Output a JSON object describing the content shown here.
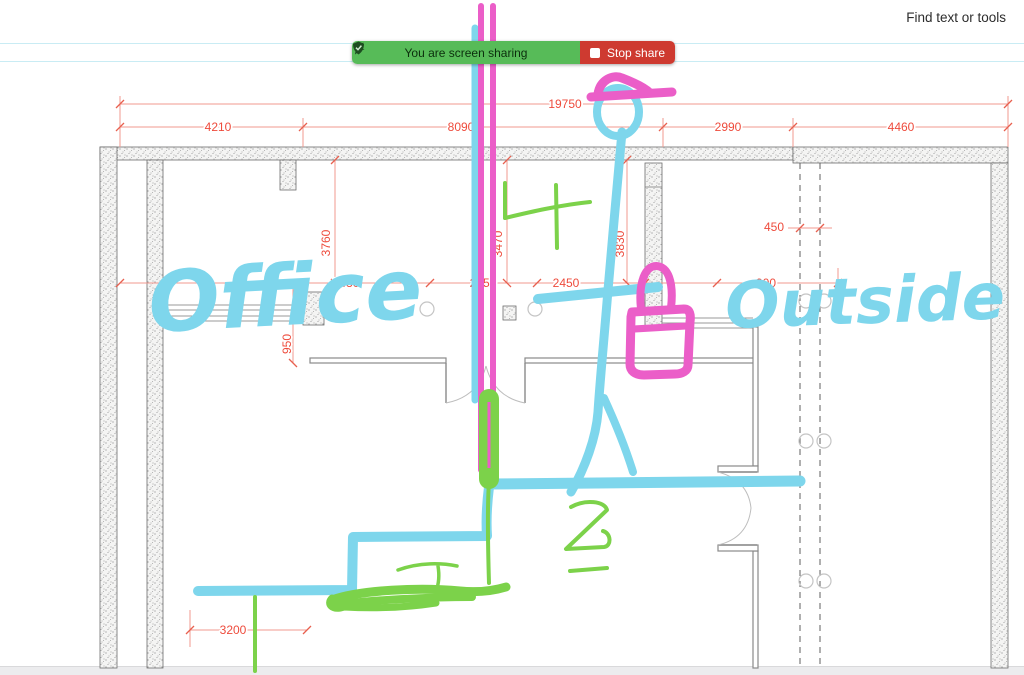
{
  "browser": {
    "find_tools_label": "Find text or tools"
  },
  "share_banner": {
    "message": "You are screen sharing",
    "stop_label": "Stop share",
    "colors": {
      "green": "#57bb58",
      "red": "#ce3a30"
    },
    "icons": [
      "cursor-icon",
      "shield-check-icon",
      "stop-square-icon"
    ]
  },
  "plan": {
    "handwriting": {
      "room_left": "Office",
      "room_right": "Outside"
    },
    "doodles": [
      "stick-figure",
      "pink-hat",
      "padlock",
      "pink-double-pipe",
      "green-scribbles",
      "cyan-route-lines"
    ],
    "colors": {
      "marker_cyan": "#7ed6ec",
      "marker_pink": "#eb5ec8",
      "marker_green": "#7cd24a",
      "dimension_red": "#ee4b3c"
    },
    "dimensions": [
      {
        "label": "19750",
        "x": 565,
        "y": 108,
        "rot": 0
      },
      {
        "label": "4210",
        "x": 218,
        "y": 131,
        "rot": 0
      },
      {
        "label": "8090",
        "x": 461,
        "y": 131,
        "rot": 0
      },
      {
        "label": "2990",
        "x": 728,
        "y": 131,
        "rot": 0
      },
      {
        "label": "4460",
        "x": 901,
        "y": 131,
        "rot": 0
      },
      {
        "label": "3760",
        "x": 330,
        "y": 243,
        "rot": -90
      },
      {
        "label": "3470",
        "x": 502,
        "y": 244,
        "rot": -90
      },
      {
        "label": "3830",
        "x": 624,
        "y": 244,
        "rot": -90
      },
      {
        "label": "2430",
        "x": 346,
        "y": 287,
        "rot": 0
      },
      {
        "label": "2450",
        "x": 483,
        "y": 287,
        "rot": 0
      },
      {
        "label": "2450",
        "x": 566,
        "y": 287,
        "rot": 0
      },
      {
        "label": "900",
        "x": 766,
        "y": 287,
        "rot": 0
      },
      {
        "label": "450",
        "x": 774,
        "y": 231,
        "rot": 0
      },
      {
        "label": "950",
        "x": 291,
        "y": 344,
        "rot": -90
      },
      {
        "label": "3200",
        "x": 233,
        "y": 634,
        "rot": 0
      }
    ]
  }
}
